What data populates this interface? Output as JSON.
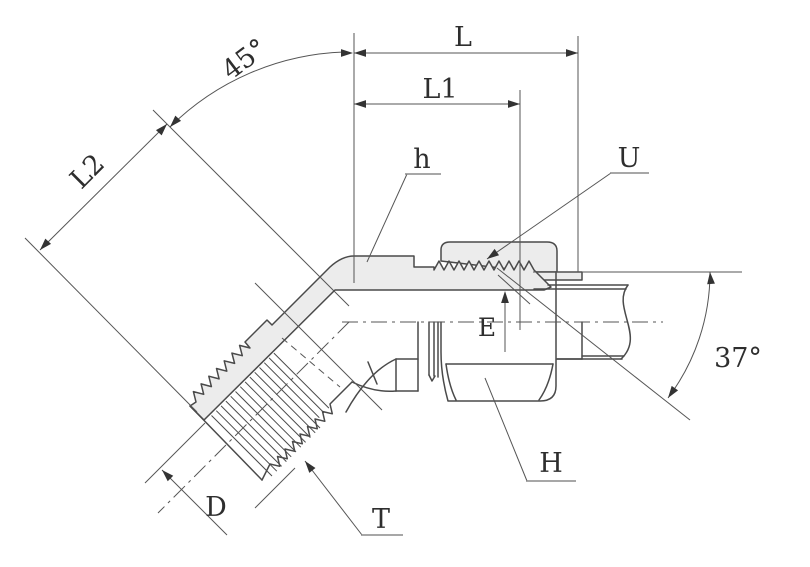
{
  "drawing": {
    "type": "technical-drawing",
    "subject": "45 degree flare tube fitting elbow, half-section view",
    "colors": {
      "line": "#4a4a4a",
      "thin_line": "#555555",
      "section_fill": "#ececec",
      "background": "#ffffff",
      "text": "#2e2e2e"
    },
    "labels": {
      "L": "L",
      "L1": "L1",
      "L2": "L2",
      "angle_bend": "45°",
      "h": "h",
      "U": "U",
      "E": "E",
      "angle_flare": "37°",
      "D": "D",
      "T": "T",
      "H": "H"
    }
  }
}
